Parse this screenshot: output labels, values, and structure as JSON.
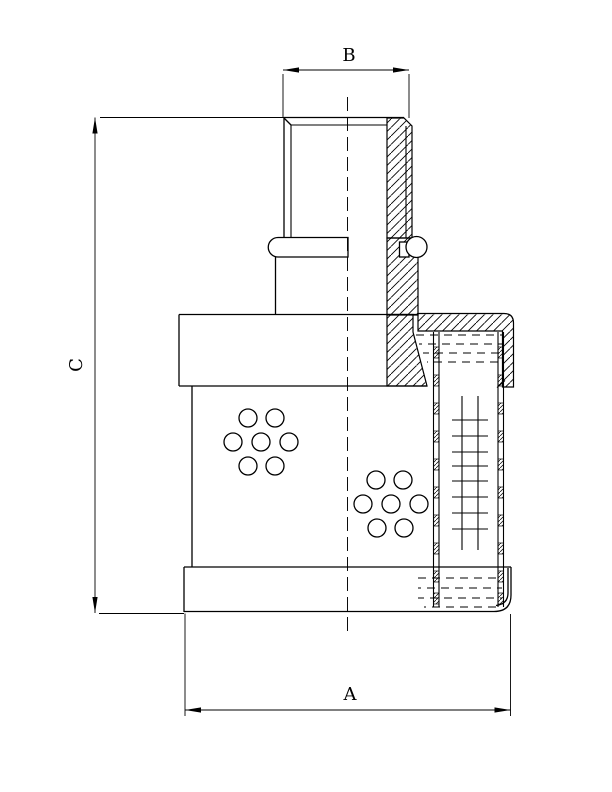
{
  "dimension_labels": {
    "top": "B",
    "left": "C",
    "bottom": "A"
  },
  "colors": {
    "line": "#000000",
    "background": "#ffffff"
  }
}
